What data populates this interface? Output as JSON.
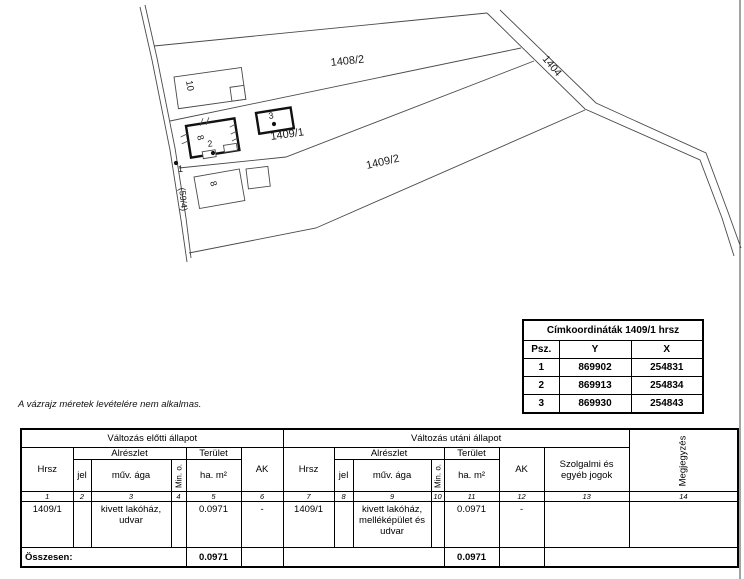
{
  "map": {
    "parcel_labels": {
      "p1408_2": "1408/2",
      "p1409_1": "1409/1",
      "p1409_2": "1409/2",
      "road_right": "1404",
      "road_left": "(59/4)"
    },
    "building_labels": {
      "b10": "10",
      "b8_main": "8",
      "b8_lower": "8"
    },
    "point_labels": {
      "pt1": "1",
      "pt2": "2",
      "pt3": "3"
    }
  },
  "coord_table": {
    "title": "Címkoordináták 1409/1 hrsz",
    "headers": {
      "psz": "Psz.",
      "y": "Y",
      "x": "X"
    },
    "rows": [
      {
        "psz": "1",
        "y": "869902",
        "x": "254831"
      },
      {
        "psz": "2",
        "y": "869913",
        "x": "254834"
      },
      {
        "psz": "3",
        "y": "869930",
        "x": "254843"
      }
    ]
  },
  "note": "A vázrajz méretek levételére nem alkalmas.",
  "main_table": {
    "before_header": "Változás előtti állapot",
    "after_header": "Változás utáni állapot",
    "h": {
      "hrsz": "Hrsz",
      "alreszlet": "Alrészlet",
      "terulet": "Terület",
      "jel": "jel",
      "muv_aga": "műv. ága",
      "min_o": "Min. o.",
      "ha_m2": "ha. m²",
      "ak": "AK",
      "szolgalmi": "Szolgalmi és\negyéb jogok",
      "megjegyzes": "Megjegyzés"
    },
    "col_numbers": [
      "1",
      "2",
      "3",
      "4",
      "5",
      "6",
      "7",
      "8",
      "9",
      "10",
      "11",
      "12",
      "13",
      "14"
    ],
    "row": {
      "before_hrsz": "1409/1",
      "before_jel": "",
      "before_muv": "kivett lakóház,\nudvar",
      "before_min_o": "",
      "before_terulet": "0.0971",
      "before_ak": "-",
      "after_hrsz": "1409/1",
      "after_jel": "",
      "after_muv": "kivett lakóház,\nmelléképület és\nudvar",
      "after_min_o": "",
      "after_terulet": "0.0971",
      "after_ak": "-",
      "szolgalmi": "",
      "megjegyzes": ""
    },
    "total": {
      "label": "Összesen:",
      "before_area": "0.0971",
      "after_area": "0.0971"
    }
  }
}
